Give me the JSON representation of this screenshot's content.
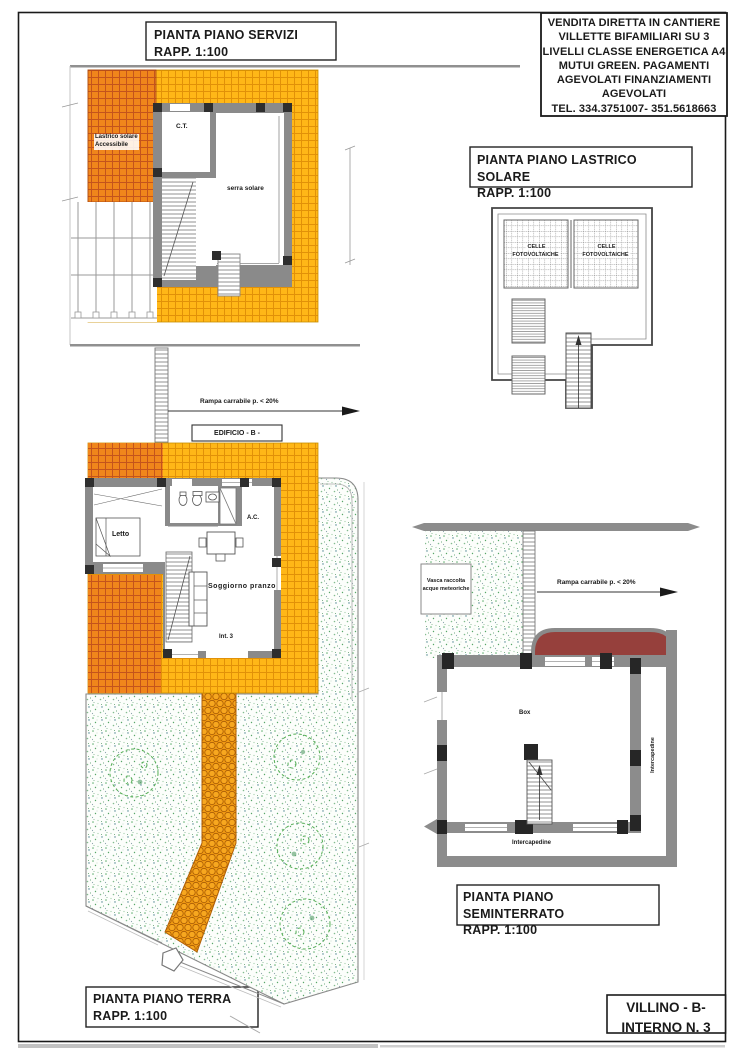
{
  "banner": {
    "text": "VENDITA DIRETTA IN CANTIERE\nVILLETTE BIFAMILIARI SU 3\nLIVELLI CLASSE ENERGETICA A4\nMUTUI GREEN. PAGAMENTI\nAGEVOLATI FINANZIAMENTI\nAGEVOLATI\nTEL. 334.3751007- 351.5618663"
  },
  "plans": {
    "servizi": {
      "title": "PIANTA PIANO SERVIZI\nRAPP. 1:100",
      "labels": {
        "lastrico_accessibile": "Lastrico solare\nAccessibile",
        "ct": "C.T.",
        "serra_solare": "serra solare"
      }
    },
    "lastrico_solare": {
      "title": "PIANTA PIANO LASTRICO SOLARE\nRAPP. 1:100",
      "labels": {
        "celle_left": "CELLE\nFOTOVOLTAICHE",
        "celle_right": "CELLE\nFOTOVOLTAICHE"
      }
    },
    "terra": {
      "title": "PIANTA PIANO TERRA\nRAPP. 1:100",
      "labels": {
        "edificio": "EDIFICIO - B -",
        "rampa": "Rampa carrabile p. < 20%",
        "letto": "Letto",
        "ac": "A.C.",
        "soggiorno": "Soggiorno pranzo",
        "int3": "Int. 3"
      }
    },
    "seminterrato": {
      "title": "PIANTA PIANO SEMINTERRATO\nRAPP. 1:100",
      "labels": {
        "vasca": "Vasca raccolta\nacque meteoriche",
        "rampa": "Rampa carrabile p. < 20%",
        "box": "Box",
        "intercapedine_right": "Intercapedine",
        "intercapedine_bottom": "Intercapedine"
      }
    }
  },
  "title_block": {
    "text": "VILLINO - B-\nINTERNO N. 3"
  },
  "colors": {
    "tile_dark": "#F0861B",
    "tile_dark_grid": "#C4541C",
    "tile_light": "#FFB717",
    "tile_light_grid": "#E19108",
    "path_fill": "#F09A12",
    "arch_red": "#96403C",
    "wall_gray": "#8A8A8A",
    "pilaster": "#2E2E2E",
    "tree_green": "#54AE54"
  }
}
